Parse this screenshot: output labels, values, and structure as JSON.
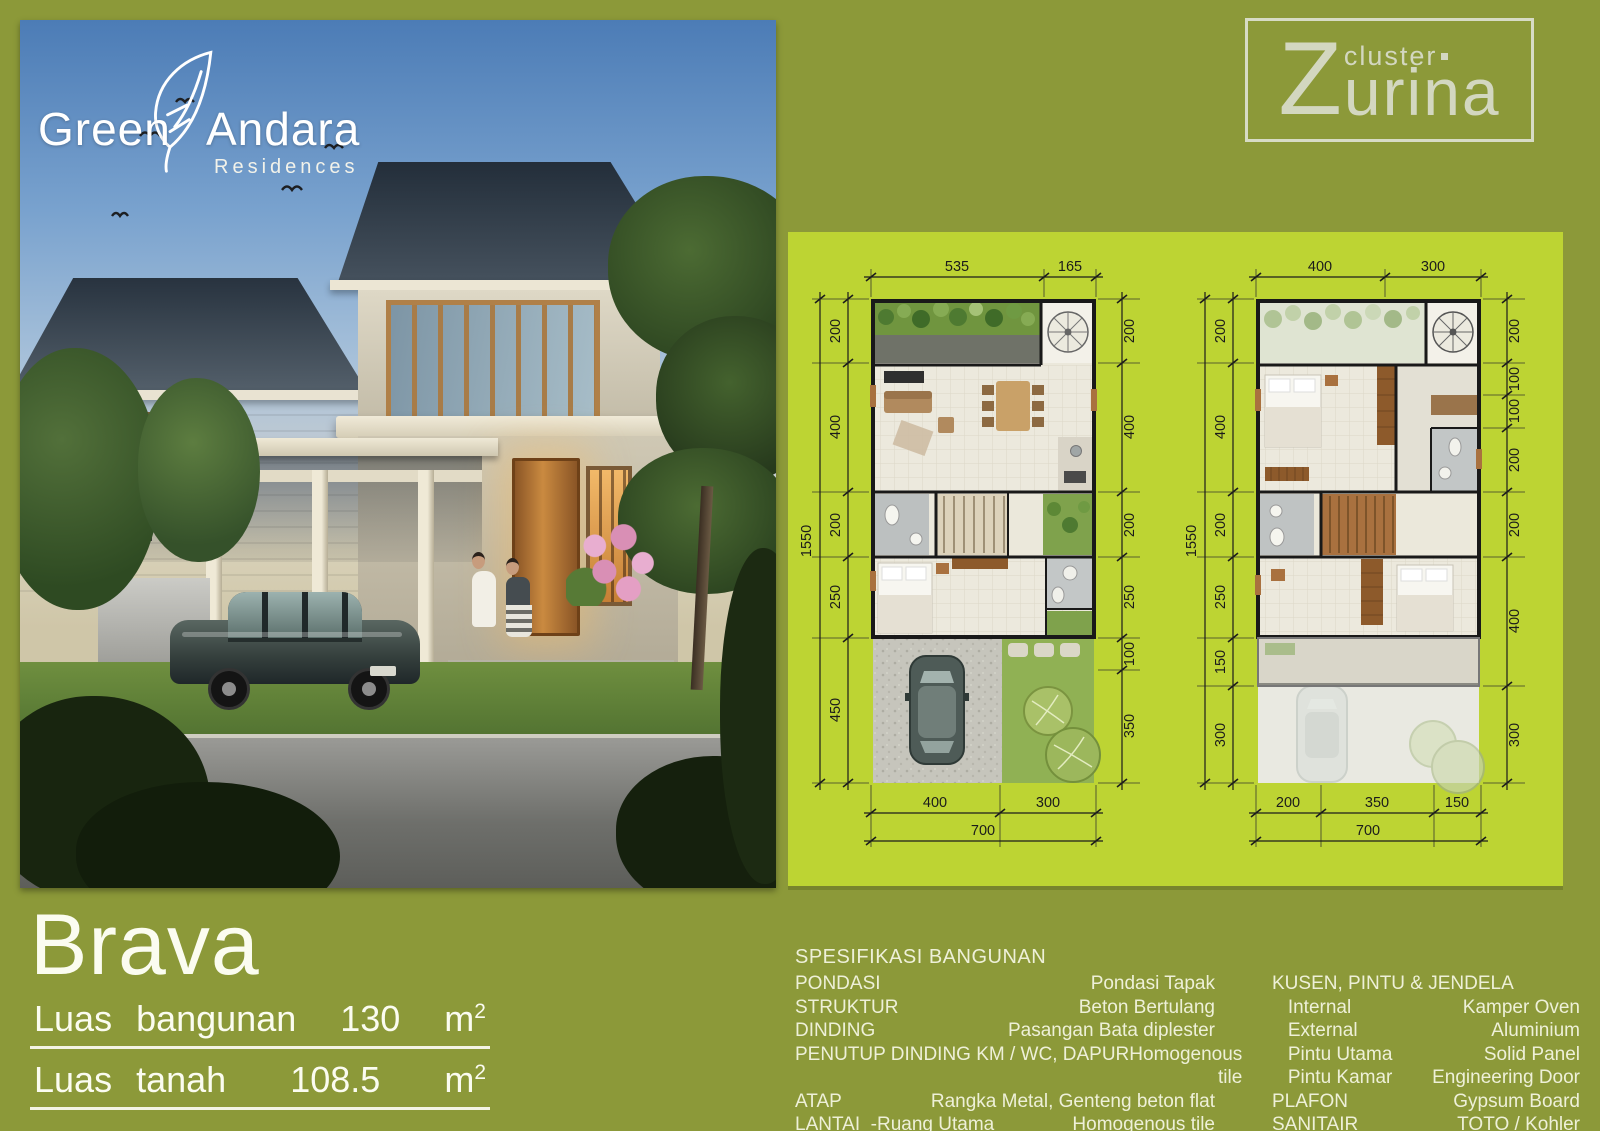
{
  "colors": {
    "background": "#8c9939",
    "panel": "#bdd433",
    "text_light": "#eef0d8",
    "dimension": "#1b1b1b"
  },
  "brand_logo": {
    "word1": "Green",
    "word2": "Andara",
    "word3": "Residences"
  },
  "cluster_logo": {
    "initial": "Z",
    "small_word": "cluster",
    "rest": "urina"
  },
  "unit_block": {
    "name": "Brava",
    "rows": [
      {
        "label": "Luas bangunan",
        "value": "130",
        "unit": "m",
        "sup": "2"
      },
      {
        "label": "Luas tanah",
        "value": "108.5",
        "unit": "m",
        "sup": "2"
      }
    ]
  },
  "specs": {
    "title": "SPESIFIKASI BANGUNAN",
    "left": [
      {
        "label": "PONDASI",
        "value": "Pondasi Tapak"
      },
      {
        "label": "STRUKTUR",
        "value": "Beton Bertulang"
      },
      {
        "label": "DINDING",
        "value": "Pasangan Bata diplester"
      },
      {
        "label": "PENUTUP DINDING KM / WC, DAPUR",
        "value": "Homogenous tile"
      },
      {
        "label": "ATAP",
        "value": "Rangka Metal, Genteng beton flat"
      },
      {
        "label": "LANTAI  -Ruang Utama",
        "value": "Homogenous tile"
      },
      {
        "label": "             -KM / WC, Dapur",
        "value": "Homogenous tile"
      }
    ],
    "right": [
      {
        "label": "KUSEN, PINTU & JENDELA",
        "value": ""
      },
      {
        "label": "   Internal",
        "value": "Kamper Oven"
      },
      {
        "label": "   External",
        "value": "Aluminium"
      },
      {
        "label": "   Pintu Utama",
        "value": "Solid Panel"
      },
      {
        "label": "   Pintu Kamar",
        "value": "Engineering Door"
      },
      {
        "label": "PLAFON",
        "value": "Gypsum Board"
      },
      {
        "label": "SANITAIR",
        "value": "TOTO / Kohler"
      },
      {
        "label": "LISTRIK",
        "value": "2.200 Watt"
      }
    ]
  },
  "floorplans": {
    "ground": {
      "dims_top": [
        "535",
        "165"
      ],
      "dims_left_total": "1550",
      "dims_left": [
        "200",
        "400",
        "200",
        "250",
        "450"
      ],
      "dims_right": [
        "200",
        "400",
        "200",
        "250",
        "100",
        "350"
      ],
      "dims_bottom": [
        "400",
        "300"
      ],
      "dims_bottom_total": "700"
    },
    "upper": {
      "dims_top": [
        "400",
        "300"
      ],
      "dims_left_total": "1550",
      "dims_left": [
        "200",
        "400",
        "200",
        "250",
        "150",
        "300"
      ],
      "dims_right": [
        "200",
        "100",
        "100",
        "200",
        "200",
        "400",
        "300"
      ],
      "dims_bottom": [
        "200",
        "350",
        "150"
      ],
      "dims_bottom_total": "700"
    }
  }
}
